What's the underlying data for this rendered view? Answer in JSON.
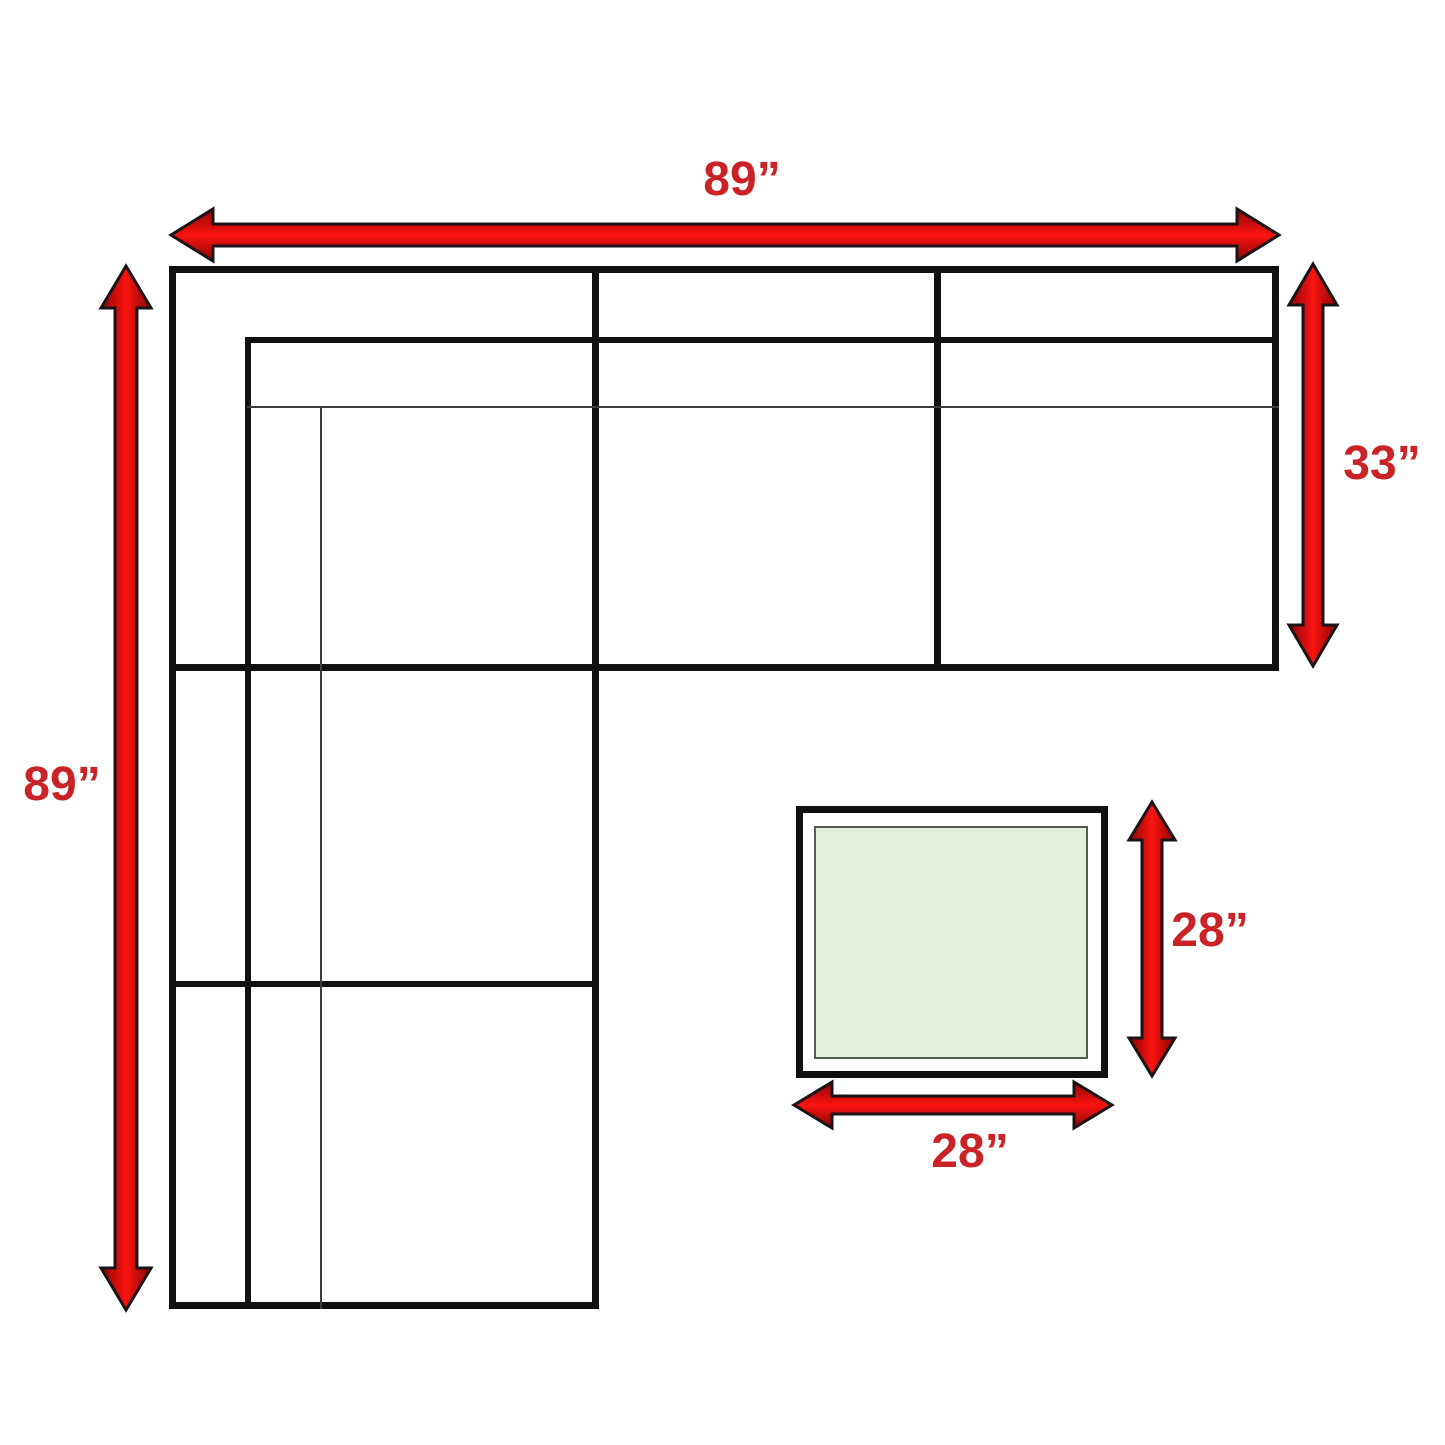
{
  "diagram": {
    "dimensions": {
      "sofa_width": {
        "label": "89”"
      },
      "sofa_depth": {
        "label": "89”"
      },
      "chaise_depth": {
        "label": "33”"
      },
      "ottoman_depth": {
        "label": "28”"
      },
      "ottoman_width": {
        "label": "28”"
      }
    },
    "colors": {
      "line_color": "#101010",
      "thin_line_color": "#3c3c3c",
      "label_red": "#c92328",
      "arrow_red_center": "#fa1410",
      "arrow_red_edge": "#8a0406",
      "arrow_outline": "#1b1416",
      "ottoman_fill": "#e3efdc",
      "ottoman_border": "#565c50"
    }
  }
}
